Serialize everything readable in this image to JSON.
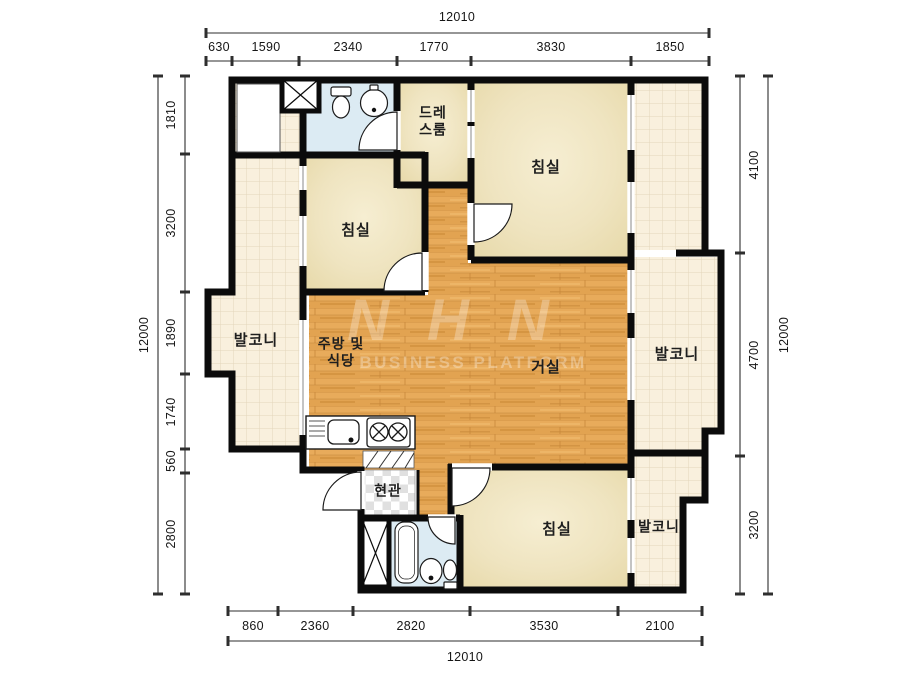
{
  "title": "apartment-floor-plan",
  "rooms": {
    "dressroom": "드레\n스룸",
    "bedroom_top_left": "침실",
    "bedroom_top_right": "침실",
    "bedroom_bottom": "침실",
    "balcony_left": "발코니",
    "balcony_right": "발코니",
    "balcony_bottom": "발코니",
    "kitchen": "주방 및\n식당",
    "living": "거실",
    "entrance": "현관"
  },
  "dimensions": {
    "top": {
      "total": "12010",
      "segments": [
        "630",
        "1590",
        "2340",
        "1770",
        "3830",
        "1850"
      ]
    },
    "bottom": {
      "total": "12010",
      "segments": [
        "860",
        "2360",
        "2820",
        "3530",
        "2100"
      ]
    },
    "left": {
      "total": "12000",
      "segments": [
        "1810",
        "3200",
        "1890",
        "1740",
        "560",
        "2800"
      ]
    },
    "right": {
      "total": "12000",
      "segments": [
        "4100",
        "4700",
        "3200"
      ]
    }
  },
  "watermark": {
    "logo": "NHN",
    "text": "BUSINESS PLATFORM"
  },
  "colors": {
    "wall": "#0b0b0b",
    "wood_floor": "#e2a351",
    "balcony_tile": "#f9f0dd",
    "room_fill": "#ecdfb4",
    "bathroom_fill": "#dcebf3",
    "dimension_text": "#161616"
  }
}
